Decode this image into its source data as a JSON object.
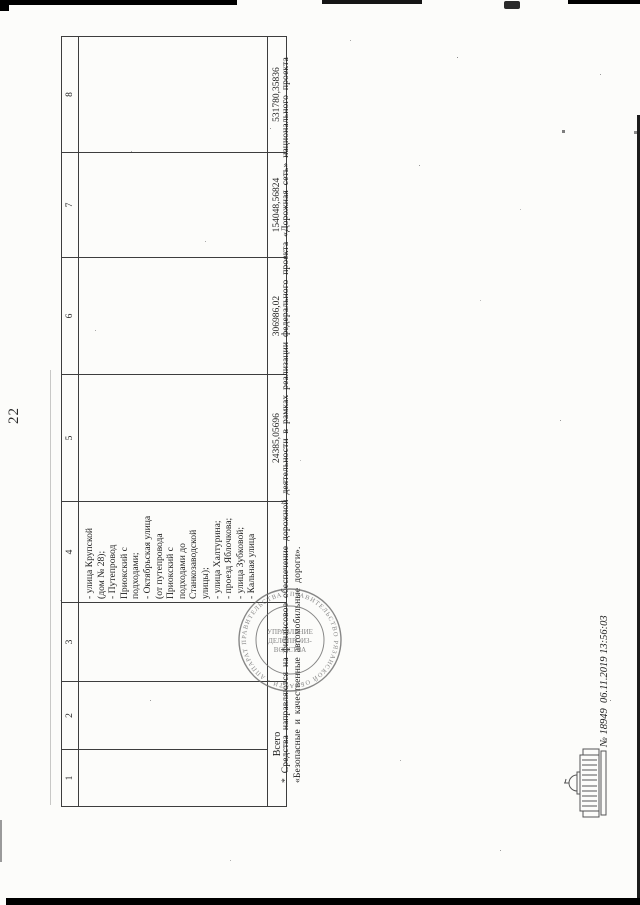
{
  "page_number": "22",
  "table": {
    "column_headers": [
      "1",
      "2",
      "3",
      "4",
      "5",
      "6",
      "7",
      "8"
    ],
    "streets_cell_lines": [
      "- улица Крупской",
      "(дом № 28);",
      "- Путепровод",
      "Приокский с",
      "подходами;",
      "- Октябрьская улица",
      "(от путепровода",
      "Приокский с",
      "подходами до",
      "Станкозаводской",
      "улицы);",
      "- улица Халтурина;",
      "- проезд Яблочкова;",
      "- улица Зубковой;",
      "- Кальная улица"
    ],
    "total_row": {
      "label": "Всего",
      "values": [
        "24385,05696",
        "306986,02",
        "154048,56824",
        "531780,35836"
      ]
    }
  },
  "footnote": {
    "line1": "* Средства направляются на финансовое обеспечение дорожной деятельности в рамках реализации федерального проекта «Дорожная сеть» национального проекта",
    "line2": "«Безопасные и качественные автомобильные дороги»."
  },
  "seal": {
    "ring_text": "ПРАВИТЕЛЬСТВО РЯЗАНСКОЙ ОБЛАСТИ • АППАРАТ ПРАВИТЕЛЬСТВА •",
    "center_line1": "УПРАВЛЕНИЕ",
    "center_line2": "ДЕЛОПРОИЗ-",
    "center_line3": "ВОДСТВА"
  },
  "registration_stamp": {
    "number_text": "№ 18949  06.11.2019 13:56:03",
    "icon": "government-building-icon"
  },
  "colors": {
    "paper": "#fcfcfa",
    "ink": "#1f1f1f",
    "table_border": "#3d3d3d",
    "seal_ink": "#6a6a6a",
    "scan_artifact": "#000000"
  }
}
